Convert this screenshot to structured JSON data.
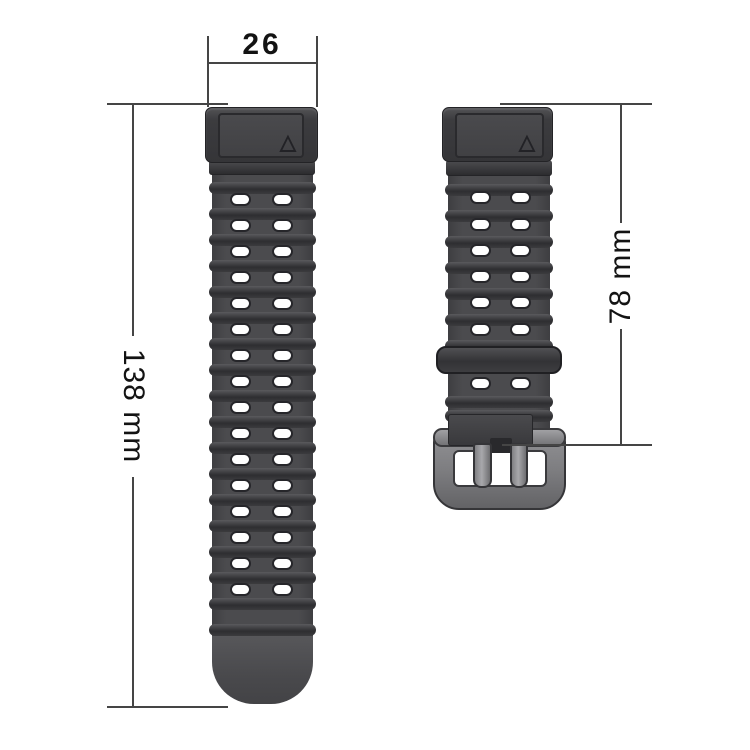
{
  "diagram": {
    "type": "watch-band-dimension-diagram",
    "band_width_label": "26",
    "long_strap_length_label": "138 mm",
    "short_strap_length_label": "78 mm"
  },
  "colors": {
    "background": "#ffffff",
    "dimension_line": "#454545",
    "dimension_text": "#131313",
    "strap_dark_gray": "#4b4b4e",
    "ridge_dark": "#2e2e31",
    "buckle_gray": "#8a8a8d",
    "hole_fill": "#ffffff"
  },
  "left_strap": {
    "description": "long strap piece with lug end, ridged surface, two columns of adjustment holes, rounded smooth tip",
    "hole_rows_y": [
      200,
      226,
      252,
      278,
      304,
      330,
      356,
      382,
      408,
      434,
      460,
      486,
      512,
      538,
      564,
      590
    ],
    "hole_cols_x": [
      230,
      272
    ],
    "ridge_rows_y": [
      182,
      208,
      234,
      260,
      286,
      312,
      338,
      364,
      390,
      416,
      442,
      468,
      494,
      520,
      546,
      572,
      598,
      624
    ]
  },
  "right_strap": {
    "description": "short strap piece with lug end, adjustment holes, keeper loop and pin buckle",
    "hole_rows_y": [
      198,
      225,
      251,
      277,
      303,
      330,
      384
    ],
    "hole_cols_x": [
      470,
      510
    ],
    "ridge_rows_y": [
      184,
      210,
      236,
      262,
      288,
      314,
      340,
      396,
      410
    ]
  }
}
